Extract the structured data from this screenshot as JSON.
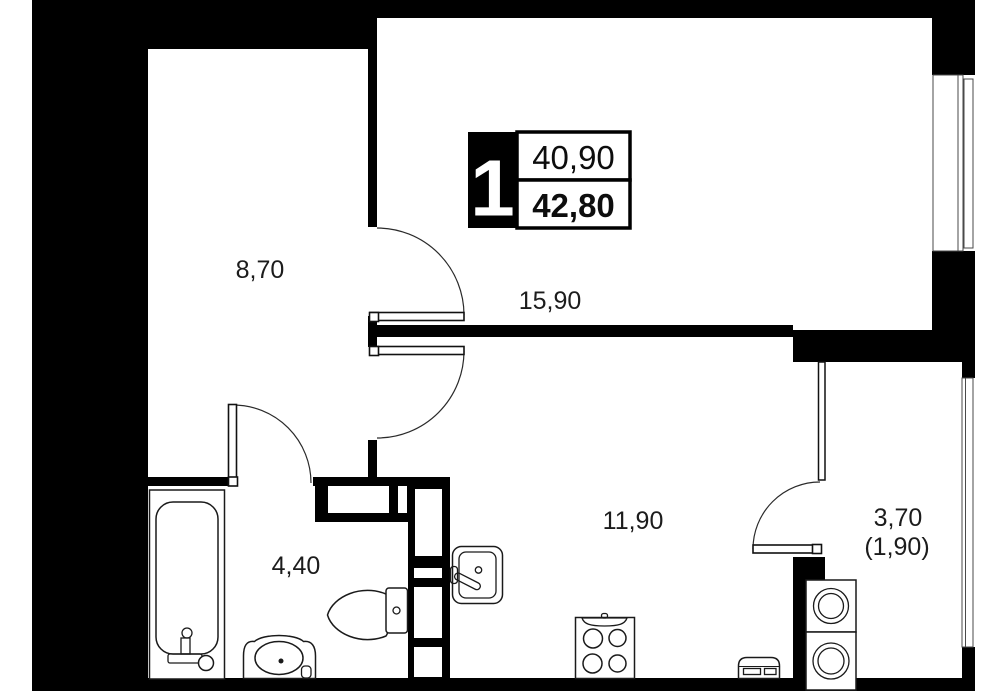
{
  "floor_plan": {
    "badge": {
      "rooms_count": "1",
      "area_living": "40,90",
      "area_total": "42,80"
    },
    "rooms": [
      {
        "name": "hallway",
        "area": "8,70"
      },
      {
        "name": "living-room",
        "area": "15,90"
      },
      {
        "name": "bathroom",
        "area": "4,40"
      },
      {
        "name": "kitchen",
        "area": "11,90"
      },
      {
        "name": "balcony",
        "area": "3,70",
        "area_reduced": "(1,90)"
      }
    ],
    "colors": {
      "wall": "#000000",
      "fixture_line": "#1a1a1a",
      "window_line": "#4a4a4a",
      "background": "#ffffff"
    }
  }
}
